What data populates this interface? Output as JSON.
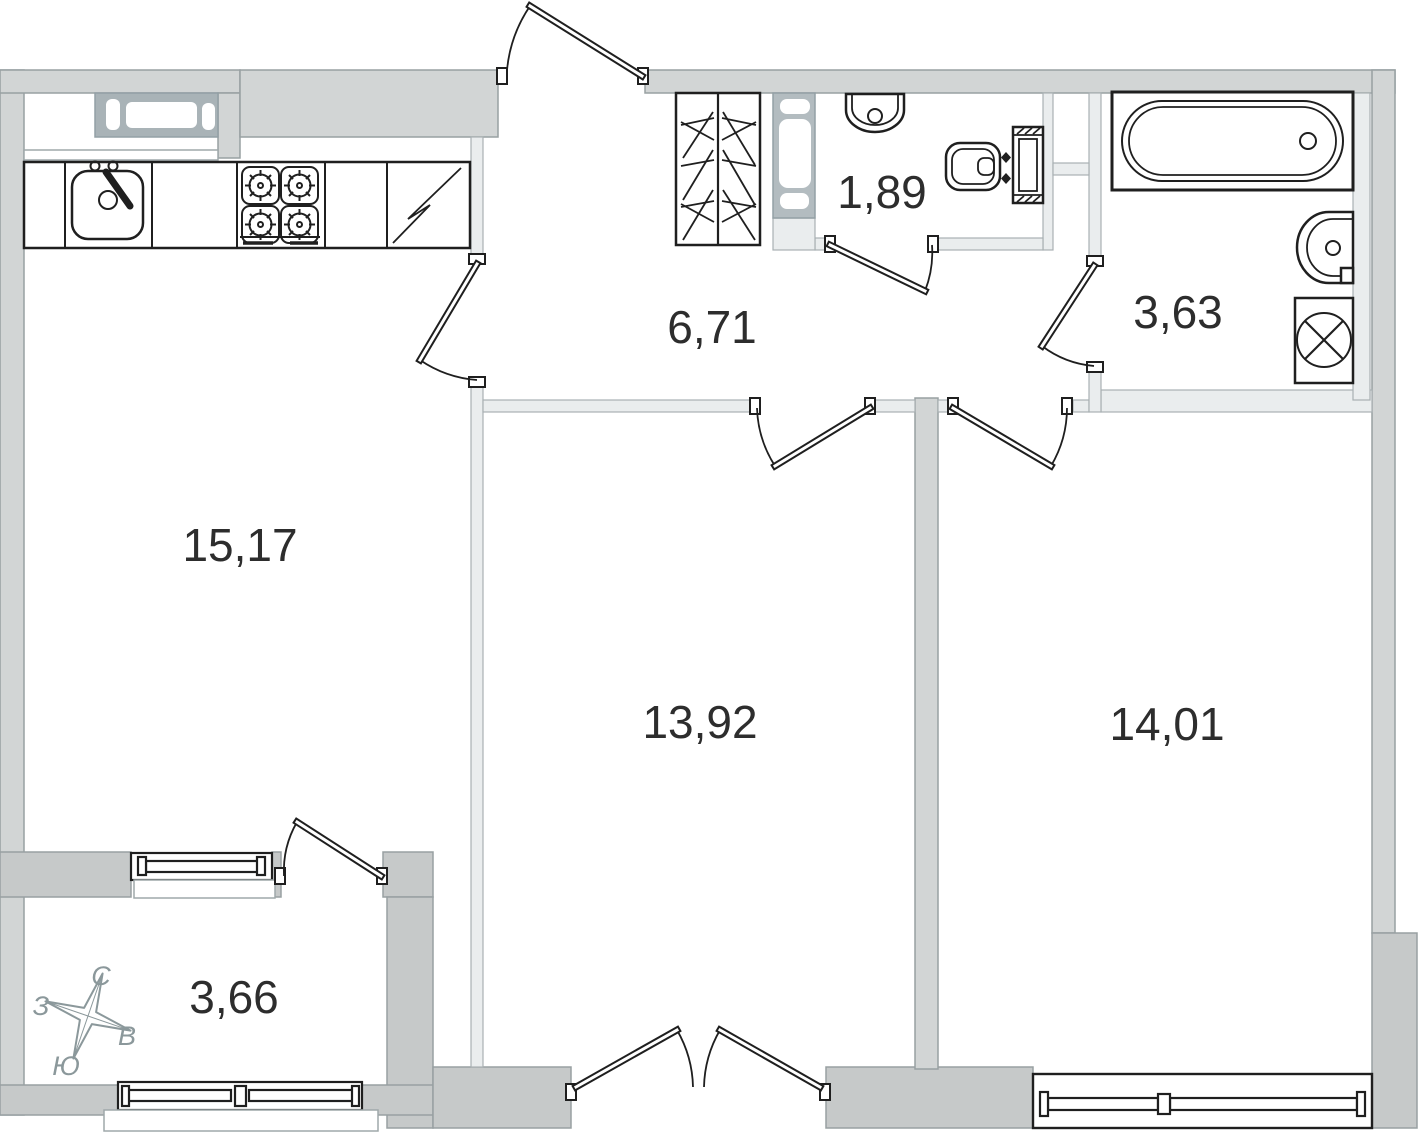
{
  "plan": {
    "rooms": [
      {
        "id": "kitchen-living",
        "area": "15,17"
      },
      {
        "id": "hallway",
        "area": "6,71"
      },
      {
        "id": "toilet",
        "area": "1,89"
      },
      {
        "id": "bathroom",
        "area": "3,63"
      },
      {
        "id": "bedroom-1",
        "area": "13,92"
      },
      {
        "id": "bedroom-2",
        "area": "14,01"
      },
      {
        "id": "balcony",
        "area": "3,66"
      }
    ],
    "compass": {
      "north": "С",
      "east": "В",
      "south": "Ю",
      "west": "З"
    },
    "colors": {
      "wall": "#d2d5d5",
      "wall-dark": "#c6c9c9",
      "wall-stroke": "#98a0a2",
      "partition": "#eaedee",
      "partition-stroke": "#a9b1b3",
      "sash": "#a9b3b7",
      "vent": "#b3bcc0",
      "ink": "#1f1f1f",
      "label": "#2d2d2d",
      "compass": "#8b989b",
      "sill-stroke": "#9fa8aa"
    }
  }
}
